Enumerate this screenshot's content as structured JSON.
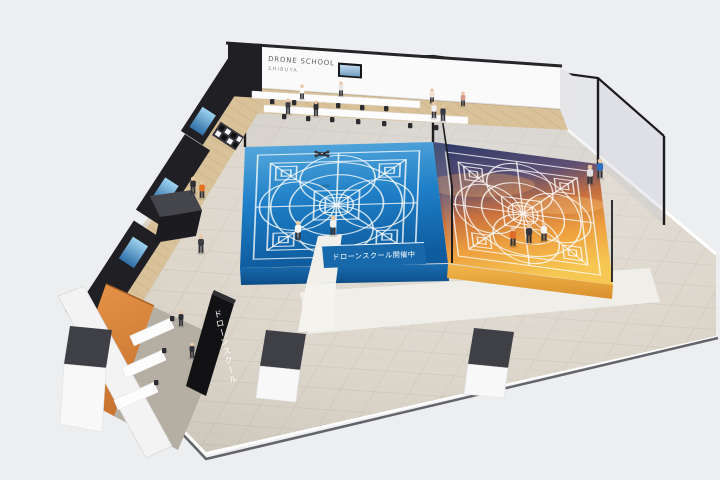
{
  "scene": {
    "description": "Isometric 3D render of an indoor drone school facility with two netted flight courts",
    "background": "#edeef0"
  },
  "signs": {
    "school_line1": "DRONE SCHOOL",
    "school_line2": "SHIBUYA",
    "court_banner": "ドローンスクール開催中",
    "pillar_sign": "ドローンスクール"
  },
  "palette": {
    "tile_floor": "#d8d1c5",
    "wood_floor": "#d9c29a",
    "dark_wall": "#1f1f24",
    "orange_wall": "#dd8a3f",
    "court_blue": "#1e7ec6",
    "sunset_top": "#323e6e",
    "sunset_bottom": "#f6c752",
    "banner_blue": "#1868ac",
    "net_frame": "#1c1c1e",
    "pedestal_top": "#3f3f46",
    "pedestal_body": "#f8f8f8"
  },
  "people": [
    {
      "x": 302,
      "y": 99,
      "s": 0.75,
      "shirt": "#ffffff"
    },
    {
      "x": 341,
      "y": 96,
      "s": 0.75,
      "shirt": "#e6e6e6"
    },
    {
      "x": 432,
      "y": 103,
      "s": 0.75,
      "shirt": "#efe0d6"
    },
    {
      "x": 463,
      "y": 106,
      "s": 0.75,
      "shirt": "#d89a8c"
    },
    {
      "x": 316,
      "y": 116,
      "s": 0.8,
      "shirt": "#2f2f36"
    },
    {
      "x": 288,
      "y": 114,
      "s": 0.8,
      "shirt": "#3c3c44"
    },
    {
      "x": 434,
      "y": 118,
      "s": 0.85,
      "shirt": "#f0f0f0"
    },
    {
      "x": 443,
      "y": 121,
      "s": 0.85,
      "shirt": "#333a46"
    },
    {
      "x": 590,
      "y": 184,
      "s": 1.0,
      "shirt": "#e0e0e0"
    },
    {
      "x": 600,
      "y": 178,
      "s": 1.0,
      "shirt": "#2d6fc0"
    },
    {
      "x": 298,
      "y": 240,
      "s": 1.0,
      "shirt": "#ffffff"
    },
    {
      "x": 333,
      "y": 235,
      "s": 1.0,
      "shirt": "#f2f2f2"
    },
    {
      "x": 513,
      "y": 246,
      "s": 1.0,
      "shirt": "#e06b2a"
    },
    {
      "x": 529,
      "y": 243,
      "s": 1.0,
      "shirt": "#35353d"
    },
    {
      "x": 544,
      "y": 241,
      "s": 1.0,
      "shirt": "#f4f4f4"
    },
    {
      "x": 193,
      "y": 194,
      "s": 0.9,
      "shirt": "#2e2e34"
    },
    {
      "x": 202,
      "y": 198,
      "s": 0.9,
      "shirt": "#e2701f"
    },
    {
      "x": 201,
      "y": 253,
      "s": 0.95,
      "shirt": "#3c3c44"
    },
    {
      "x": 181,
      "y": 326,
      "s": 0.8,
      "shirt": "#2b2b33"
    },
    {
      "x": 192,
      "y": 358,
      "s": 0.8,
      "shirt": "#30303a"
    }
  ]
}
